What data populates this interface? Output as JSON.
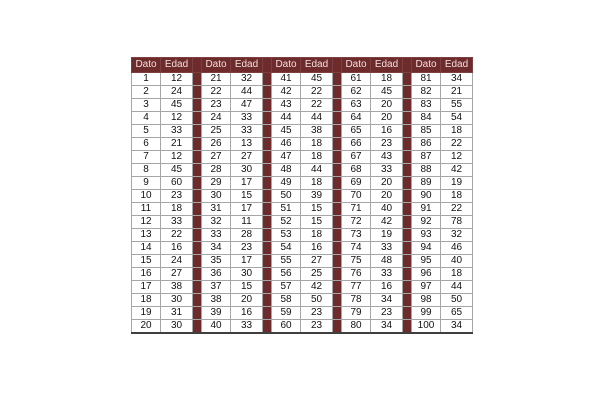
{
  "page": {
    "background": "#ffffff"
  },
  "table": {
    "header": {
      "dato": "Dato",
      "edad": "Edad"
    },
    "colors": {
      "maroon": "#6e2b2b",
      "header_text": "#f2e0e0",
      "grid": "#a6a6a6",
      "outer_border": "#3f3f3f",
      "cell_text": "#121212",
      "cell_background": "#ffffff",
      "page_background": "#ffffff"
    },
    "groups": [
      {
        "rows": [
          [
            1,
            12
          ],
          [
            2,
            24
          ],
          [
            3,
            45
          ],
          [
            4,
            12
          ],
          [
            5,
            33
          ],
          [
            6,
            21
          ],
          [
            7,
            12
          ],
          [
            8,
            45
          ],
          [
            9,
            60
          ],
          [
            10,
            23
          ],
          [
            11,
            18
          ],
          [
            12,
            33
          ],
          [
            13,
            22
          ],
          [
            14,
            16
          ],
          [
            15,
            24
          ],
          [
            16,
            27
          ],
          [
            17,
            38
          ],
          [
            18,
            30
          ],
          [
            19,
            31
          ],
          [
            20,
            30
          ]
        ]
      },
      {
        "rows": [
          [
            21,
            32
          ],
          [
            22,
            44
          ],
          [
            23,
            47
          ],
          [
            24,
            33
          ],
          [
            25,
            33
          ],
          [
            26,
            13
          ],
          [
            27,
            27
          ],
          [
            28,
            30
          ],
          [
            29,
            17
          ],
          [
            30,
            15
          ],
          [
            31,
            17
          ],
          [
            32,
            11
          ],
          [
            33,
            28
          ],
          [
            34,
            23
          ],
          [
            35,
            17
          ],
          [
            36,
            30
          ],
          [
            37,
            15
          ],
          [
            38,
            20
          ],
          [
            39,
            16
          ],
          [
            40,
            33
          ]
        ]
      },
      {
        "rows": [
          [
            41,
            45
          ],
          [
            42,
            22
          ],
          [
            43,
            22
          ],
          [
            44,
            44
          ],
          [
            45,
            38
          ],
          [
            46,
            18
          ],
          [
            47,
            18
          ],
          [
            48,
            44
          ],
          [
            49,
            18
          ],
          [
            50,
            39
          ],
          [
            51,
            15
          ],
          [
            52,
            15
          ],
          [
            53,
            18
          ],
          [
            54,
            16
          ],
          [
            55,
            27
          ],
          [
            56,
            25
          ],
          [
            57,
            42
          ],
          [
            58,
            50
          ],
          [
            59,
            23
          ],
          [
            60,
            23
          ]
        ]
      },
      {
        "rows": [
          [
            61,
            18
          ],
          [
            62,
            45
          ],
          [
            63,
            20
          ],
          [
            64,
            20
          ],
          [
            65,
            16
          ],
          [
            66,
            23
          ],
          [
            67,
            43
          ],
          [
            68,
            33
          ],
          [
            69,
            20
          ],
          [
            70,
            20
          ],
          [
            71,
            40
          ],
          [
            72,
            42
          ],
          [
            73,
            19
          ],
          [
            74,
            33
          ],
          [
            75,
            48
          ],
          [
            76,
            33
          ],
          [
            77,
            16
          ],
          [
            78,
            34
          ],
          [
            79,
            23
          ],
          [
            80,
            34
          ]
        ]
      },
      {
        "rows": [
          [
            81,
            34
          ],
          [
            82,
            21
          ],
          [
            83,
            55
          ],
          [
            84,
            54
          ],
          [
            85,
            18
          ],
          [
            86,
            22
          ],
          [
            87,
            12
          ],
          [
            88,
            42
          ],
          [
            89,
            19
          ],
          [
            90,
            18
          ],
          [
            91,
            22
          ],
          [
            92,
            78
          ],
          [
            93,
            32
          ],
          [
            94,
            46
          ],
          [
            95,
            40
          ],
          [
            96,
            18
          ],
          [
            97,
            44
          ],
          [
            98,
            50
          ],
          [
            99,
            65
          ],
          [
            100,
            34
          ]
        ]
      }
    ]
  }
}
